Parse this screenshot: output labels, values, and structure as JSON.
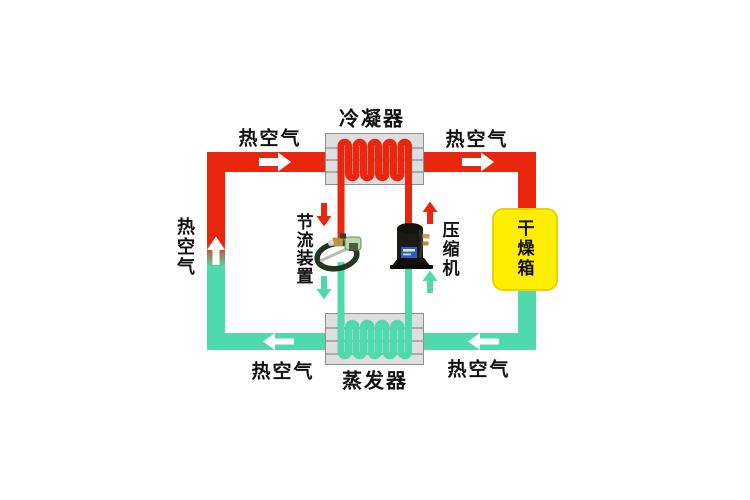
{
  "diagram": {
    "type": "heat-pump-drying-system-schematic",
    "labels": {
      "condenser": "冷凝器",
      "evaporator": "蒸发器",
      "throttle_device": "节流装置",
      "compressor": "压缩机",
      "drying_box": "干燥箱",
      "hot_air_top_left": "热空气",
      "hot_air_top_right": "热空气",
      "hot_air_bottom_left": "热空气",
      "hot_air_bottom_right": "热空气",
      "hot_air_left_vertical": "热空气"
    },
    "colors": {
      "hot_pipe": "#e8270e",
      "cold_pipe": "#4fd9ac",
      "drying_box_fill": "#ffee00",
      "drying_box_border": "#e8d400",
      "exchanger_fill": "#dedede",
      "exchanger_border": "#8f8f8f",
      "exchanger_fin_line": "#a9a9a9",
      "text": "#111111",
      "arrow_white": "#ffffff"
    },
    "flow_arrows": [
      {
        "id": "air-top-left",
        "color": "white",
        "direction": "right",
        "on": "hot air duct into condenser"
      },
      {
        "id": "air-top-right",
        "color": "white",
        "direction": "right",
        "on": "hot air duct into drying box"
      },
      {
        "id": "air-bottom-right",
        "color": "white",
        "direction": "left",
        "on": "air duct from drying box to evaporator"
      },
      {
        "id": "air-bottom-left",
        "color": "white",
        "direction": "left",
        "on": "air duct from evaporator"
      },
      {
        "id": "air-left-up",
        "color": "white",
        "direction": "up",
        "on": "air duct rising, cold-to-hot transition"
      },
      {
        "id": "refrigerant-condenser-to-throttle",
        "color": "red",
        "direction": "down"
      },
      {
        "id": "refrigerant-throttle-to-evaporator",
        "color": "teal",
        "direction": "down"
      },
      {
        "id": "refrigerant-compressor-to-condenser",
        "color": "red",
        "direction": "up"
      },
      {
        "id": "refrigerant-evaporator-to-compressor",
        "color": "teal",
        "direction": "up"
      }
    ]
  }
}
